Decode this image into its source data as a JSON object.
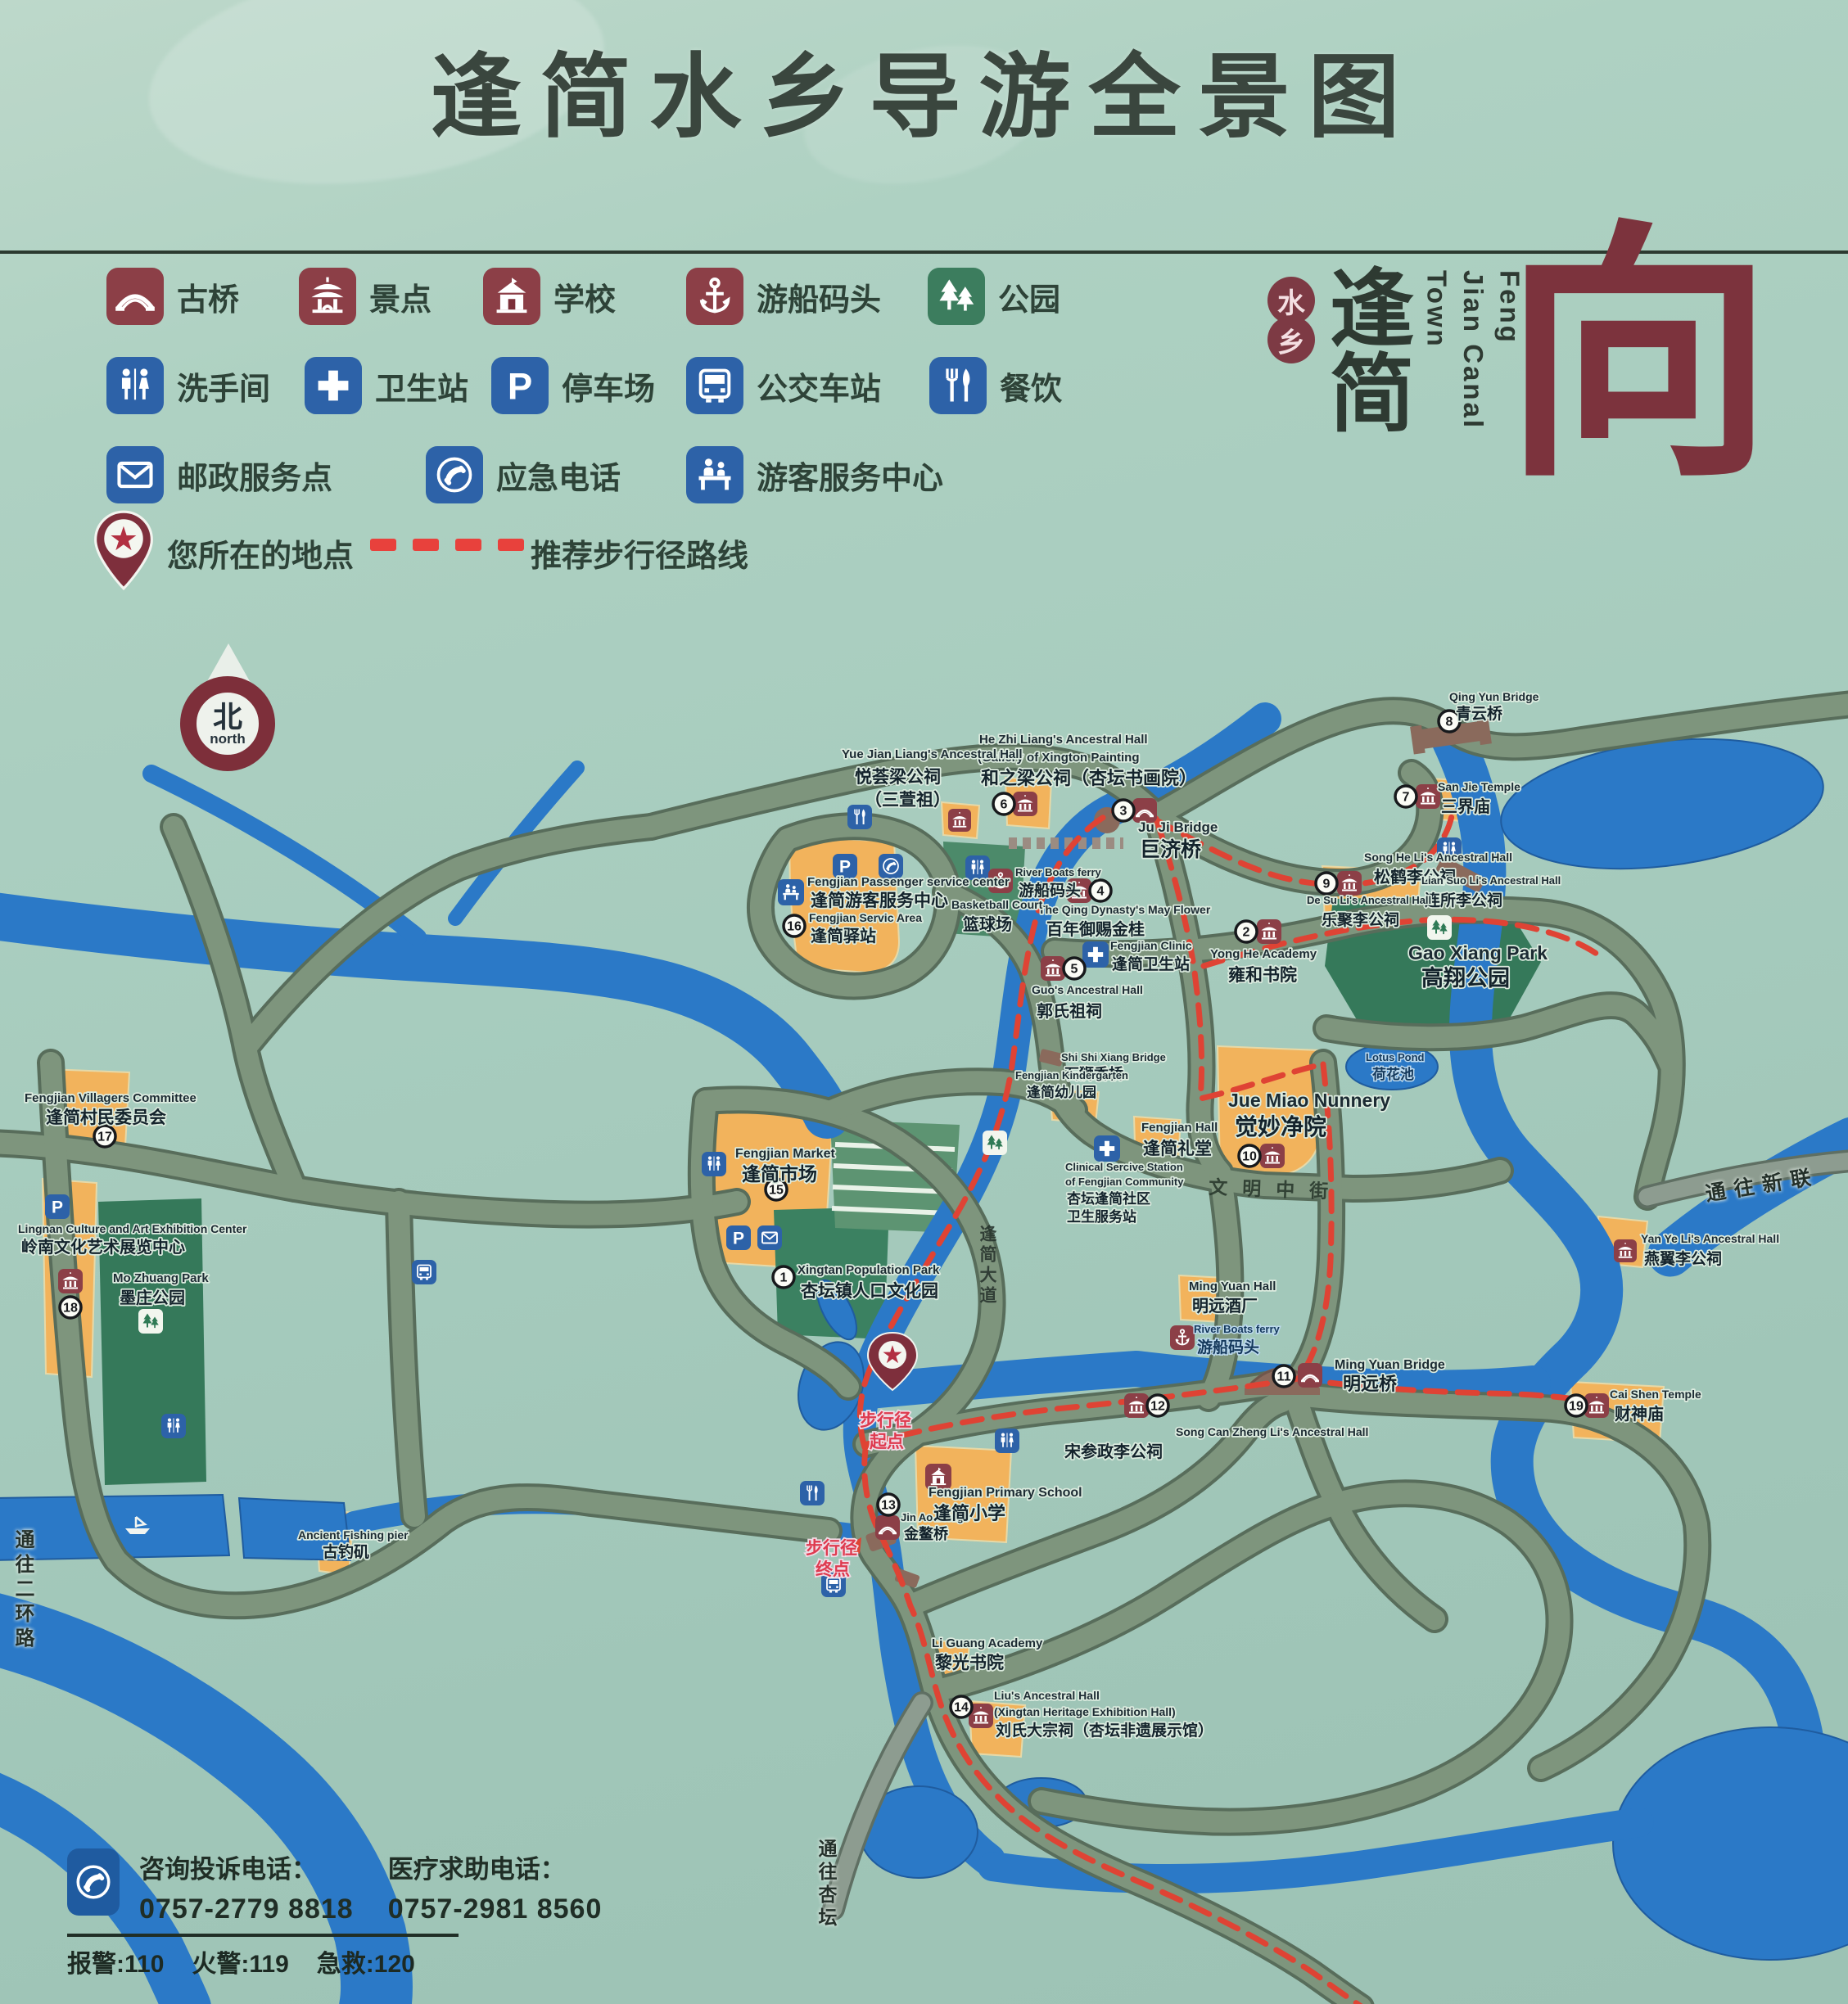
{
  "title": "逢简水乡导游全景图",
  "colors": {
    "maroon": "#8c3f47",
    "blue": "#2d62a8",
    "green": "#3c7d5e",
    "water": "#2b79c7",
    "road": "#7e957d",
    "orange": "#f2b35c",
    "route_red": "#df4334",
    "bg": "#a9cec0"
  },
  "legend": {
    "rows": [
      [
        {
          "icon": "bridge-icon",
          "label": "古桥"
        },
        {
          "icon": "scenic-spot-icon",
          "label": "景点"
        },
        {
          "icon": "school-icon",
          "label": "学校"
        },
        {
          "icon": "boat-dock-icon",
          "label": "游船码头"
        },
        {
          "icon": "park-icon",
          "label": "公园"
        }
      ],
      [
        {
          "icon": "restroom-icon",
          "label": "洗手间"
        },
        {
          "icon": "health-station-icon",
          "label": "卫生站"
        },
        {
          "icon": "parking-icon",
          "label": "停车场"
        },
        {
          "icon": "bus-station-icon",
          "label": "公交车站"
        },
        {
          "icon": "dining-icon",
          "label": "餐饮"
        }
      ],
      [
        {
          "icon": "postal-icon",
          "label": "邮政服务点"
        },
        {
          "icon": "emergency-phone-icon",
          "label": "应急电话"
        },
        {
          "icon": "visitor-center-icon",
          "label": "游客服务中心"
        }
      ]
    ],
    "location_label": "您所在的地点",
    "route_label": "推荐步行径路线"
  },
  "logo": {
    "seal_top": "水",
    "seal_bottom": "乡",
    "name": "逢简",
    "en_line1": "Feng Jian",
    "en_line2": "Canal Town",
    "glyph": "向"
  },
  "north": {
    "zh": "北",
    "en": "north"
  },
  "map": {
    "pois": [
      {
        "n": "1",
        "en": "Xingtan Population Park",
        "zh": "杏坛镇人口文化园"
      },
      {
        "n": "2",
        "en": "Yong He Academy",
        "zh": "雍和书院"
      },
      {
        "n": "3",
        "en": "Ju Ji Bridge",
        "zh": "巨济桥"
      },
      {
        "n": "4",
        "en": "The Qing Dynasty's May Flower",
        "zh": "百年御赐金桂"
      },
      {
        "n": "5",
        "en": "Guo's Ancestral Hall",
        "zh": "郭氏祖祠"
      },
      {
        "n": "6",
        "en": "He Zhi Liang's Ancestral Hall",
        "en2": "(Gallery of Xington Painting",
        "zh": "和之梁公祠（杏坛书画院）"
      },
      {
        "n": "7",
        "en": "San Jie Temple",
        "zh": "三界庙"
      },
      {
        "n": "8",
        "en": "Qing Yun Bridge",
        "zh": "青云桥"
      },
      {
        "n": "9",
        "en": "Song He Li's Ancestral Hall",
        "zh": "松鹤李公祠"
      },
      {
        "n": "10",
        "en": "Jue Miao Nunnery",
        "zh": "觉妙净院"
      },
      {
        "n": "11",
        "en": "Ming Yuan Bridge",
        "zh": "明远桥"
      },
      {
        "n": "12",
        "en": "Song Can Zheng Li's Ancestral Hall",
        "zh": "宋参政李公祠"
      },
      {
        "n": "13",
        "en": "Jin Ao Bridge",
        "zh": "金鳌桥"
      },
      {
        "n": "14",
        "en": "Liu's Ancestral Hall",
        "en2": "(Xingtan Heritage Exhibition Hall)",
        "zh": "刘氏大宗祠（杏坛非遗展示馆）"
      },
      {
        "n": "15",
        "en": "Fengjian Market",
        "zh": "逢简市场"
      },
      {
        "n": "16",
        "en": "Fengjian Servic Area",
        "zh": "逢简驿站"
      },
      {
        "n": "17",
        "en": "Fengjian Villagers Committee",
        "zh": "逢简村民委员会"
      },
      {
        "n": "18",
        "en": "Lingnan Culture and Art Exhibition Center",
        "zh": "岭南文化艺术展览中心"
      },
      {
        "n": "19",
        "en": "Cai Shen Temple",
        "zh": "财神庙"
      }
    ],
    "places": [
      {
        "en": "Yue Jian Liang's Ancestral Hall",
        "zh": "悦荟梁公祠",
        "zh2": "（三萱祖）"
      },
      {
        "en": "Fengjian Passenger service center",
        "zh": "逢简游客服务中心"
      },
      {
        "en": "River Boats ferry",
        "zh": "游船码头"
      },
      {
        "en": "Basketball Court",
        "zh": "篮球场"
      },
      {
        "en": "Fengjian Clinic",
        "zh": "逢简卫生站"
      },
      {
        "en": "Shi Shi Xiang Bridge",
        "zh": "石狮香桥"
      },
      {
        "en": "Fengjian Kindergarten",
        "zh": "逢简幼儿园"
      },
      {
        "en": "Fengjian Hall",
        "zh": "逢简礼堂"
      },
      {
        "en": "Clinical Sercive Station",
        "en2": "of Fengjian Community",
        "zh": "杏坛逢简社区",
        "zh2": "卫生服务站"
      },
      {
        "en": "Gao Xiang Park",
        "zh": "高翔公园"
      },
      {
        "en": "Lotus Pond",
        "zh": "荷花池"
      },
      {
        "en": "Ming Yuan Hall",
        "zh": "明远酒厂"
      },
      {
        "en": "Lian Suo Li's Ancestral Hall",
        "zh": "连所李公祠"
      },
      {
        "en": "De Su Li's Ancestral Hall",
        "zh": "乐聚李公祠"
      },
      {
        "en": "Yan Ye Li's Ancestral Hall",
        "zh": "燕翼李公祠"
      },
      {
        "en": "Fengjian Primary School",
        "zh": "逢简小学"
      },
      {
        "en": "Li Guang Academy",
        "zh": "黎光书院"
      },
      {
        "en": "Ancient Fishing pier",
        "zh": "古钓矶"
      },
      {
        "en": "Mo Zhuang Park",
        "zh": "墨庄公园"
      }
    ],
    "streets": {
      "wenming": "文明中街",
      "dadao": "逢简大道"
    },
    "roadsigns": {
      "xinlian": "通往新联",
      "erhuan": "通往二环路",
      "xingtan": "通往杏坛"
    },
    "route_notes": {
      "start_line1": "步行径",
      "start_line2": "起点",
      "end_line1": "步行径",
      "end_line2": "终点"
    }
  },
  "contact": {
    "line1_label": "咨询投诉电话：",
    "line1_value": "0757-2779 8818",
    "line2_label": "医疗求助电话：",
    "line2_value": "0757-2981 8560",
    "emergency": [
      "报警:110",
      "火警:119",
      "急救:120"
    ]
  }
}
